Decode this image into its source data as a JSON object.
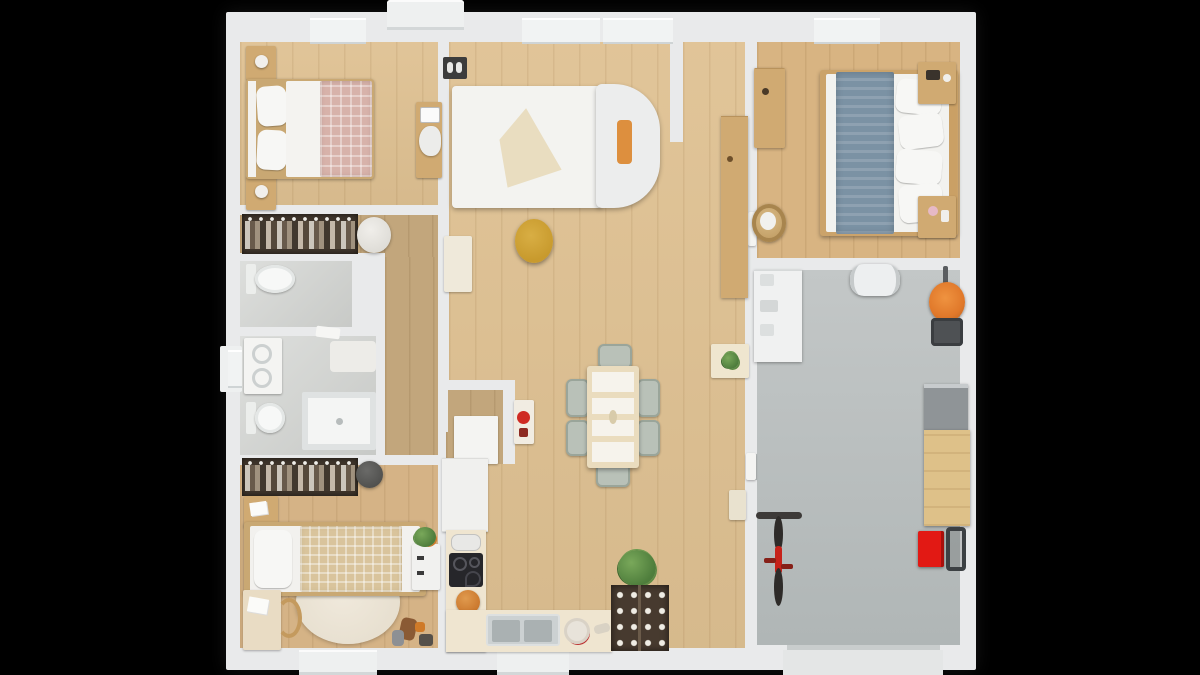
{
  "scene": {
    "kind": "3d-floorplan-top-view-render",
    "style": "photoreal architectural dollhouse view on black background",
    "visible_text": []
  },
  "palette": {
    "bg": "#000000",
    "wall": "#e9eaeb",
    "wall-shade": "#cfd4d5",
    "wood": "#dfc192",
    "wood-hall": "#c2a67c",
    "wood-kids": "#d5b386",
    "wood-b3": "#d8b482",
    "bath-floor": "#d2d4d1",
    "garage-floor": "#b0b6b6",
    "wardrobe-dark": "#3f352b",
    "furn-tan": "#d0aa72",
    "blanket-pink": "#d7b2aa",
    "blanket-blue": "#7b92a4",
    "blanket-beige": "#d9c49c",
    "chair-sage": "#b9c1b8",
    "table-cream": "#eadcbe",
    "counter-cream": "#efe5d0",
    "pantry-brown": "#473a2f",
    "accent-orange": "#dd8f3e",
    "pouf-yellow": "#c89a2d",
    "mower-orange": "#e0782a",
    "bike-red": "#c6221a",
    "toolbox-red": "#e21914",
    "cooktop-black": "#26262a",
    "sink-gray": "#aab1b2"
  },
  "rooms": [
    {
      "name": "bedroom-1",
      "items": [
        "double-bed",
        "pink-checkered-blanket",
        "nightstand-with-lamp",
        "nightstand-with-lamp",
        "desk",
        "chair",
        "laptop"
      ]
    },
    {
      "name": "hallway",
      "items": [
        "open-wardrobe-hanging-clothes",
        "round-pouf"
      ]
    },
    {
      "name": "wc",
      "items": [
        "toilet"
      ]
    },
    {
      "name": "bathroom",
      "items": [
        "vanity-washbasin",
        "toilet",
        "walk-in-shower",
        "bath-mat",
        "towel",
        "window"
      ]
    },
    {
      "name": "kids-bedroom",
      "items": [
        "single-bed",
        "beige-checkered-blanket",
        "round-rug",
        "desk-with-papers",
        "wooden-chair",
        "nightstand",
        "open-wardrobe-hanging-clothes",
        "beanbag",
        "toys"
      ]
    },
    {
      "name": "kitchen",
      "items": [
        "l-shaped-counter",
        "induction-cooktop",
        "toaster",
        "double-sink",
        "fruit-bowl",
        "orange-pot",
        "pepper-mill",
        "pantry-shelf-with-jars",
        "utility-nook",
        "coffee-station-red-kettle",
        "dresser-with-flowers"
      ]
    },
    {
      "name": "dining-area",
      "items": [
        "dining-table",
        "six-sage-chairs",
        "potted-plant"
      ]
    },
    {
      "name": "living-room",
      "items": [
        "white-daybed-sofa",
        "orange-cushion",
        "beige-throw",
        "yellow-pouf",
        "shoe-tray",
        "tall-cabinet",
        "side-table-with-plant",
        "sideboard",
        "bench"
      ]
    },
    {
      "name": "bedroom-3",
      "items": [
        "double-bed",
        "blue-blanket",
        "white-pillows",
        "nightstand",
        "nightstand",
        "dresser",
        "laundry-basket"
      ]
    },
    {
      "name": "garage",
      "items": [
        "shelving-unit",
        "roof-cargo-box",
        "lawn-mower",
        "workbench",
        "tool-cabinet",
        "red-toolbox-stool",
        "hand-truck",
        "red-bicycle",
        "garage-door-apron"
      ]
    }
  ],
  "exterior": [
    "entrance-porch-top",
    "porch-kids-room",
    "porch-kitchen",
    "garage-driveway-apron",
    "windows-top-wall",
    "window-left-wall"
  ]
}
